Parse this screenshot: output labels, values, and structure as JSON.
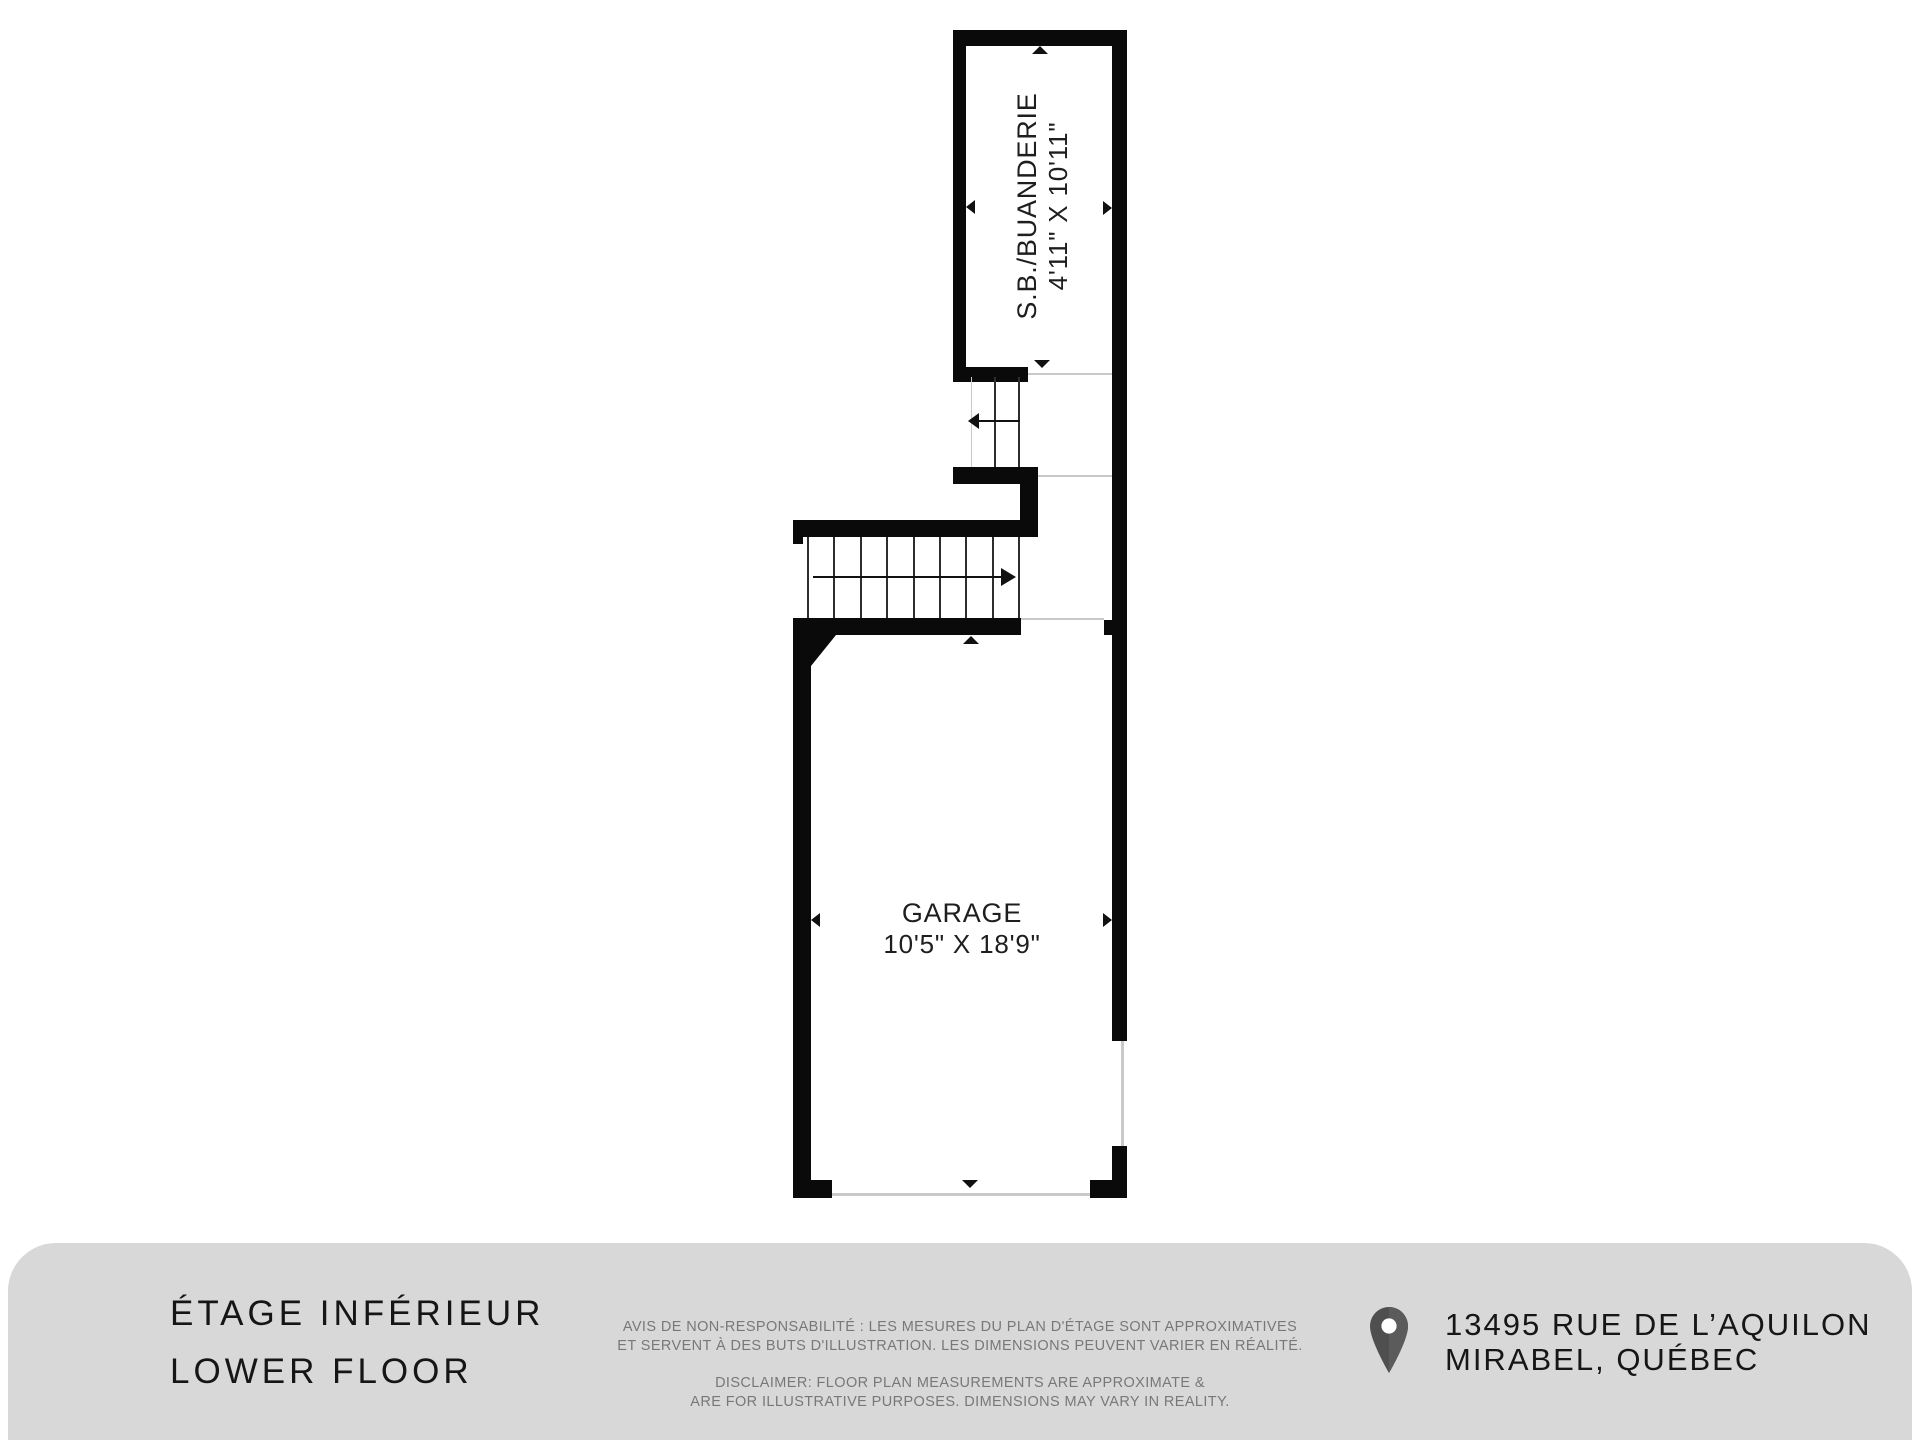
{
  "colors": {
    "wall": "#0a0a0a",
    "footer_background": "#d8d8d8",
    "title_text": "#151515",
    "disclaimer_text": "#787878",
    "opening_line": "#c9c9c9",
    "pin_icon": "#4f4f4f"
  },
  "plan": {
    "laundry_room": {
      "label": "S.B./BUANDERIE",
      "dimensions": "4'11\" X 10'11\""
    },
    "garage": {
      "label": "GARAGE",
      "dimensions": "10'5\" X 18'9\""
    }
  },
  "footer": {
    "title_fr": "ÉTAGE INFÉRIEUR",
    "title_en": "LOWER FLOOR",
    "disclaimer_fr": [
      "AVIS DE NON-RESPONSABILITÉ : LES MESURES DU PLAN D'ÉTAGE SONT APPROXIMATIVES",
      "ET SERVENT À DES BUTS D'ILLUSTRATION. LES DIMENSIONS PEUVENT VARIER EN RÉALITÉ."
    ],
    "disclaimer_en": [
      "DISCLAIMER: FLOOR PLAN MEASUREMENTS ARE APPROXIMATE &",
      "ARE FOR ILLUSTRATIVE PURPOSES. DIMENSIONS MAY VARY IN REALITY."
    ],
    "address": [
      "13495 RUE DE L’AQUILON",
      "MIRABEL, QUÉBEC"
    ]
  }
}
